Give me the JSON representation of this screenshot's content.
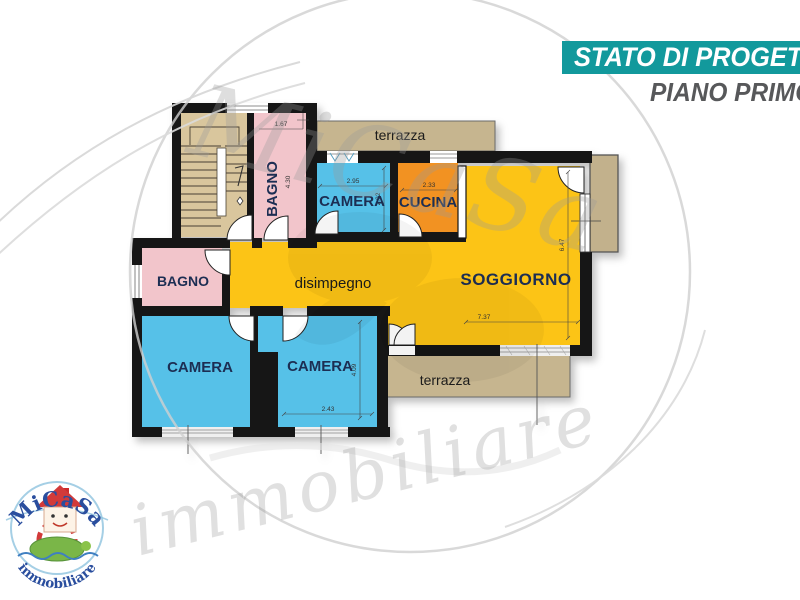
{
  "header": {
    "banner": "STATO DI PROGETTO",
    "subtitle": "PIANO PRIMO"
  },
  "plan": {
    "rooms": {
      "bagno_top": {
        "label": "BAGNO",
        "dim_width": "1.67",
        "dim_height": "4.30"
      },
      "terrazza_top": {
        "label": "terrazza"
      },
      "camera_top": {
        "label": "CAMERA",
        "dim_width": "2.95",
        "dim_height": "2.92"
      },
      "cucina": {
        "label": "CUCINA",
        "dim_width": "2.33"
      },
      "soggiorno": {
        "label": "SOGGIORNO",
        "dim_width": "7.37",
        "dim_height": "6.47"
      },
      "disimpegno": {
        "label": "disimpegno"
      },
      "bagno_left": {
        "label": "BAGNO"
      },
      "camera_bottom_left": {
        "label": "CAMERA"
      },
      "camera_bottom_mid": {
        "label": "CAMERA",
        "dim_width": "2.43",
        "dim_height": "4.09"
      },
      "terrazza_bottom": {
        "label": "terrazza"
      }
    }
  },
  "watermark": {
    "word_top": "MiCaSa",
    "word_bottom": "immobiliare"
  },
  "logo": {
    "brand": "MiCaSa",
    "tagline": "immobiliare"
  },
  "colors": {
    "accent_teal": "#12999c",
    "subtitle_gray": "#57585a",
    "wall": "#161616",
    "room_yellow": "#fcc418",
    "room_blue": "#57c1e8",
    "room_pink": "#f2c5cb",
    "room_orange": "#f29220",
    "stair_beige": "#d9c69d",
    "terrace_beige": "#c6b58f",
    "label_navy": "#1d2d52"
  }
}
